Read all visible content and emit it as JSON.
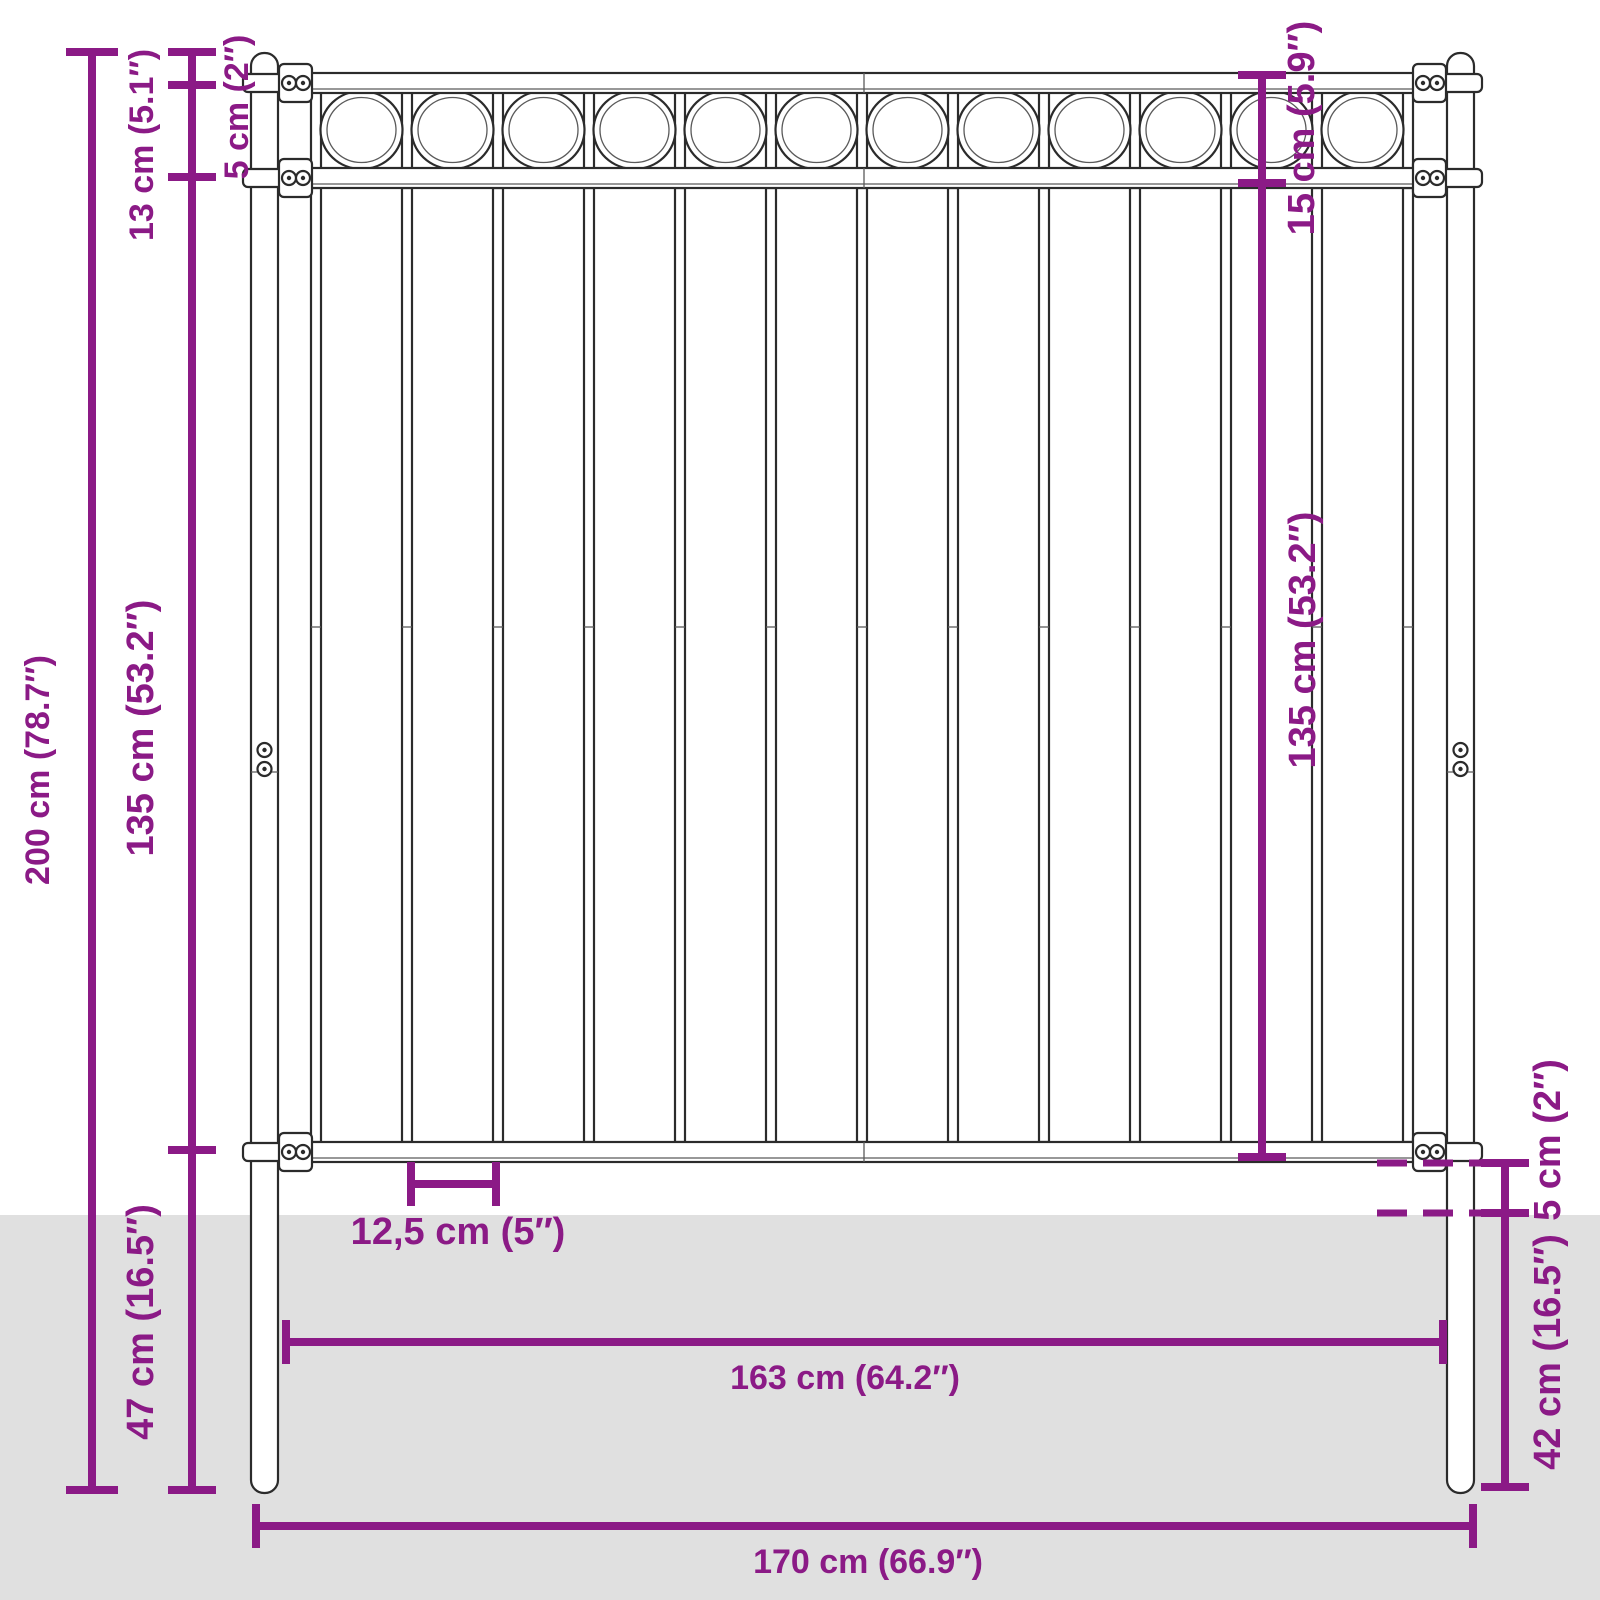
{
  "diagram": {
    "type": "product-dimension-diagram",
    "subject": "steel fence panel with two round posts and circle ornament top band",
    "style": {
      "dimension_color": "#8b1a86",
      "ground_color": "#e0e0e0",
      "line_art_color": "#2b2b2b",
      "background_color": "#ffffff"
    },
    "structure": {
      "post_count": 2,
      "rail_count": 3,
      "picket_count": 13,
      "ornament_circle_count": 12
    },
    "labels": {
      "total_height": "200 cm (78.7″)",
      "ornament_band_height": "13 cm (5.1″)",
      "post_cap_offset": "5 cm (2″)",
      "picket_height_left": "135 cm (53.2″)",
      "below_panel": "47 cm (16.5″)",
      "top_section_right": "15 cm (5.9″)",
      "picket_height_right": "135 cm (53.2″)",
      "ground_clearance": "5 cm (2″)",
      "underground_depth": "42 cm (16.5″)",
      "picket_spacing": "12,5 cm (5″)",
      "panel_width": "163 cm (64.2″)",
      "total_width": "170 cm (66.9″)"
    }
  }
}
